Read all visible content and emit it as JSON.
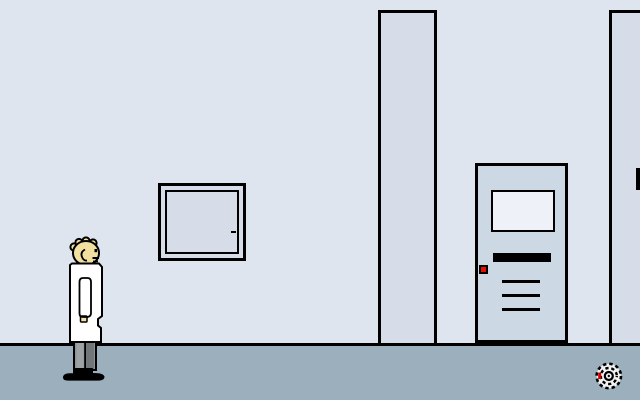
{
  "scene": {
    "name": "lab-hallway",
    "width": 640,
    "height": 400,
    "colors": {
      "wall": "#dfe5ef",
      "wall_shadow": "#d7dde8",
      "floor": "#9bafbc",
      "outline": "#000000",
      "door": "#ccd8e3",
      "door_window": "#eef1f7",
      "button_red": "#e51000",
      "skin": "#f2e0a0",
      "coat": "#ffffff",
      "pants": "#8f9497",
      "pants_light": "#9da2a5",
      "pants_dark": "#70767a",
      "shoes": "#000000",
      "drain_base": "#f2f2f2",
      "drain_red": "#cc0000"
    }
  },
  "objects": {
    "character": {
      "id": "scientist",
      "facing": "right"
    },
    "wall_panel": {
      "id": "wall-cabinet",
      "handle": "right-middle"
    },
    "door": {
      "id": "hall-door",
      "features": [
        "window",
        "black-sign",
        "red-button",
        "vent-slits"
      ]
    },
    "pillar_middle": {
      "id": "pillar-middle"
    },
    "pillar_right": {
      "id": "pillar-right"
    },
    "floor_drain": {
      "id": "spiral-drain"
    },
    "edge_object": {
      "id": "offscreen-frame-edge"
    }
  }
}
